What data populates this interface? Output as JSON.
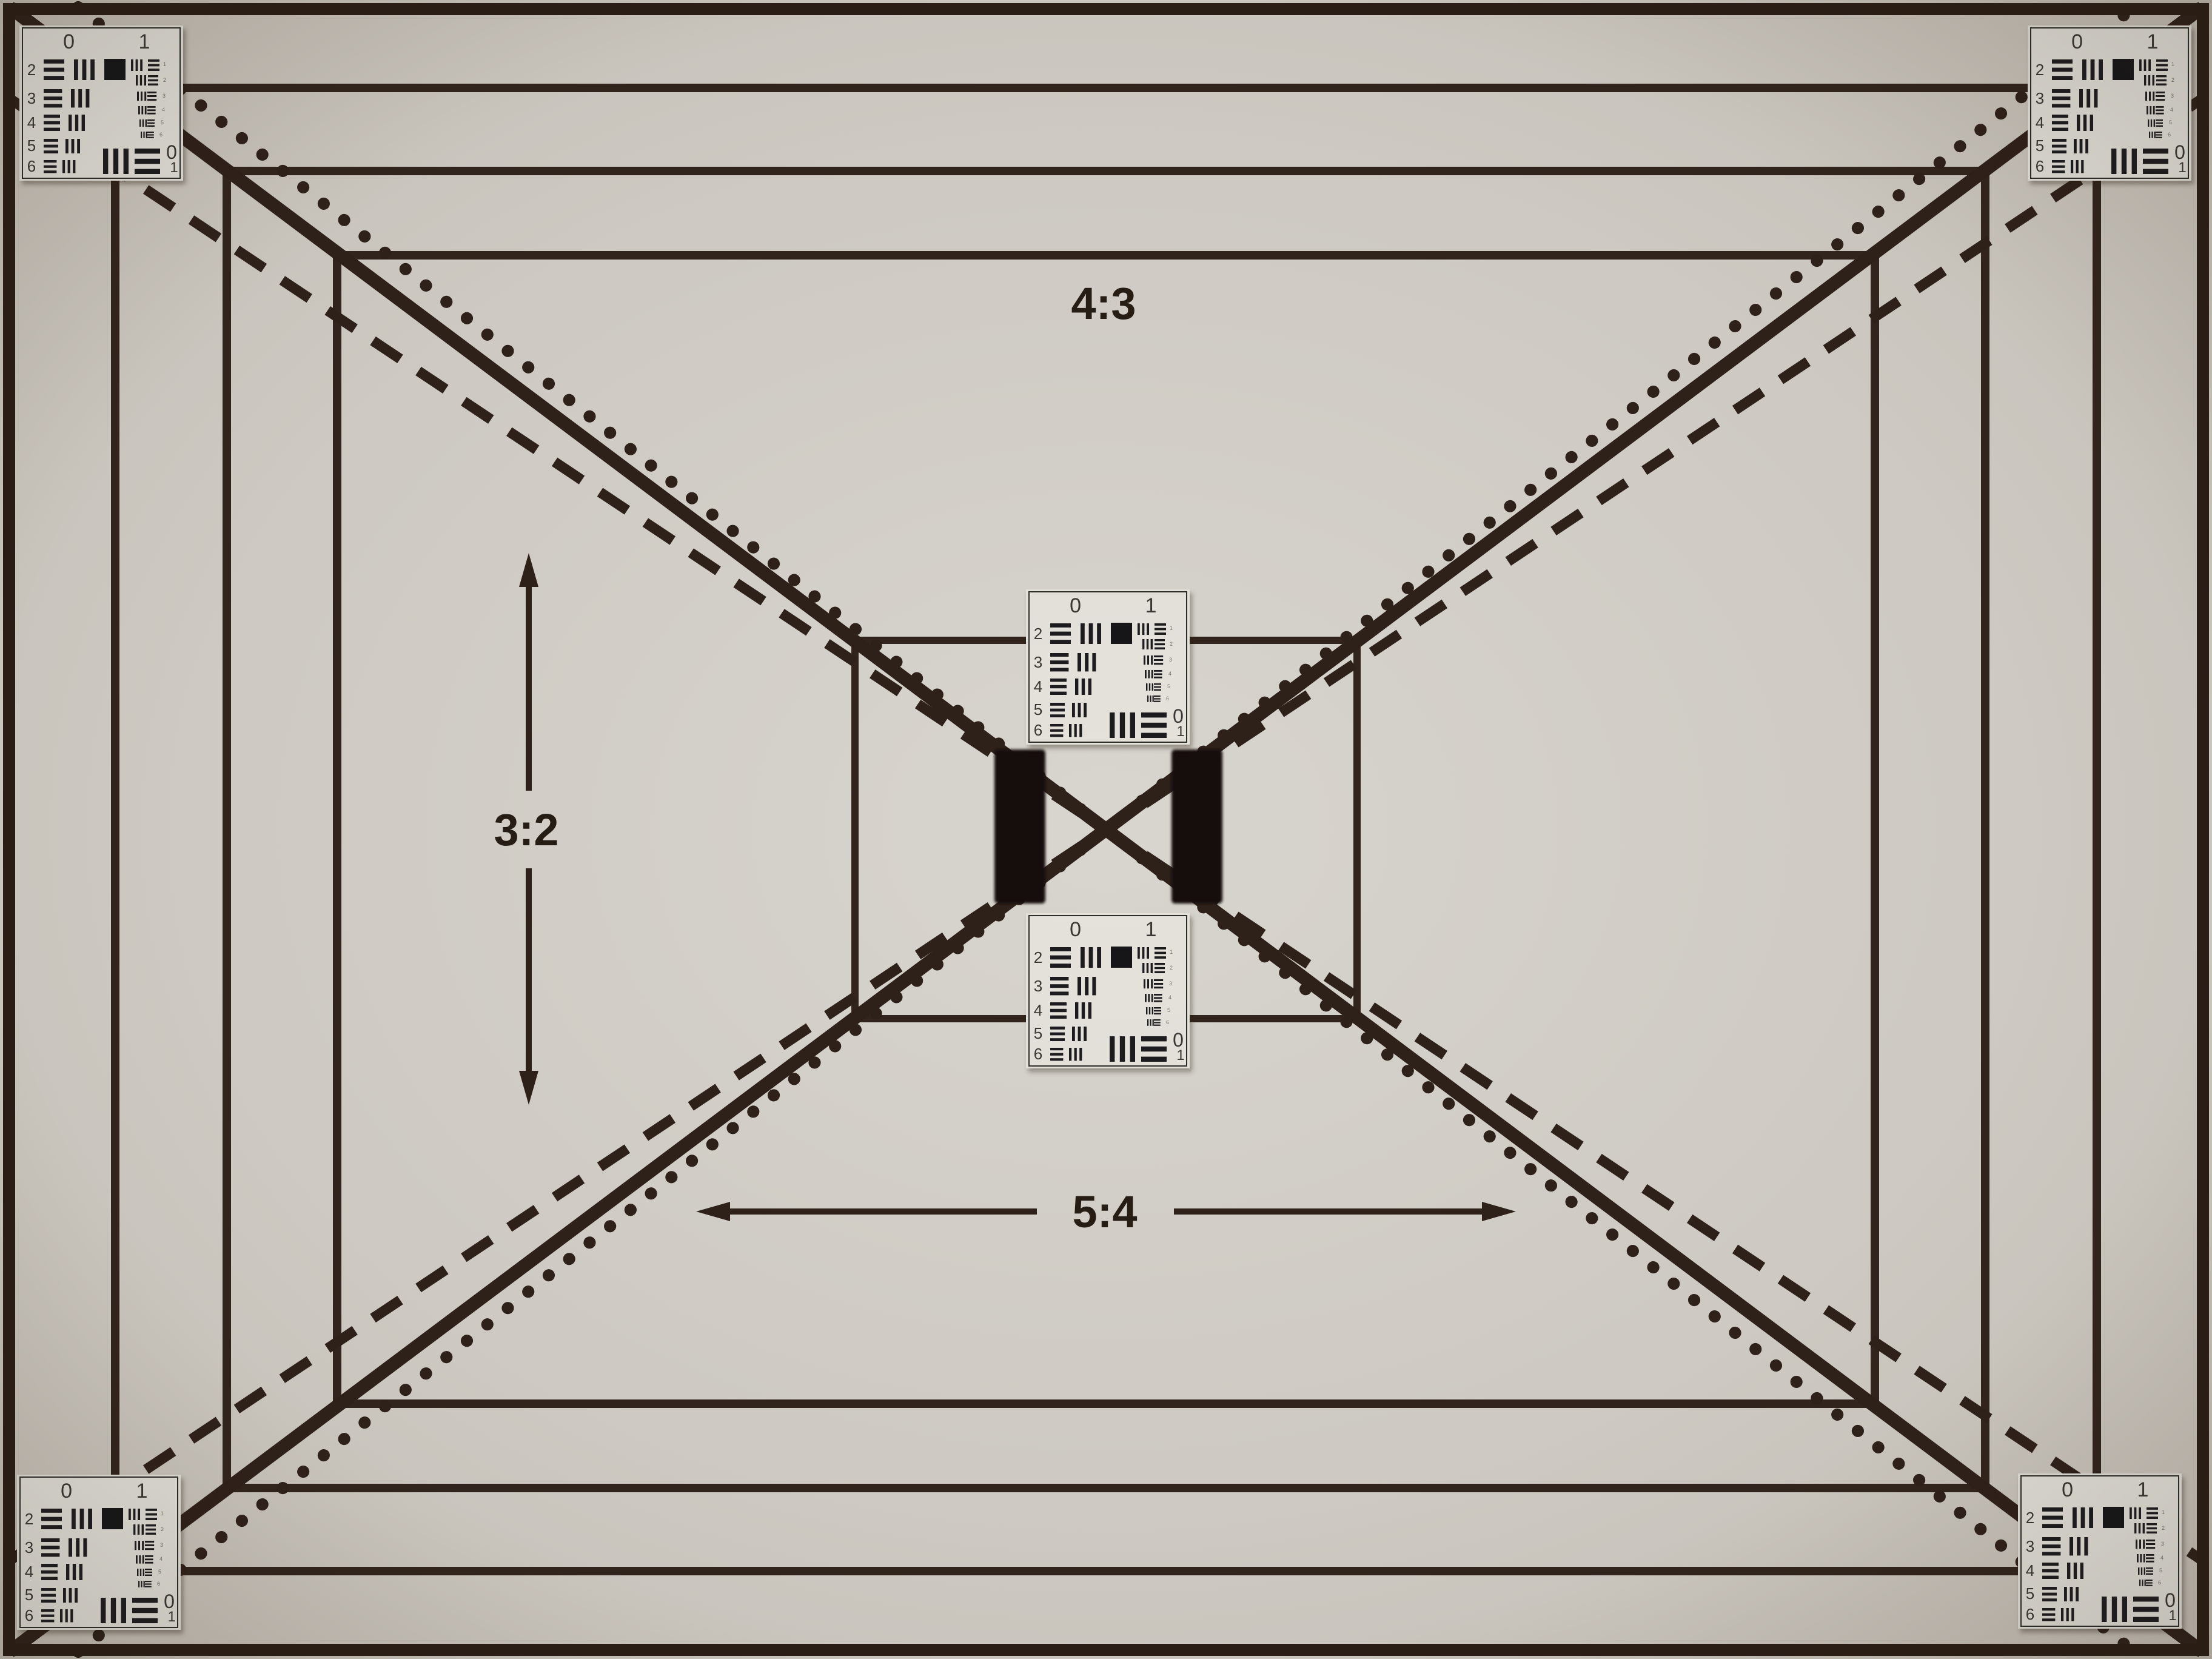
{
  "labels": {
    "top_aspect": "4:3",
    "left_aspect": "3:2",
    "bottom_aspect": "5:4"
  },
  "usaf": {
    "group_label_left": "0",
    "group_label_right": "1",
    "left_numbers": [
      "2",
      "3",
      "4",
      "5",
      "6"
    ],
    "right_numbers": [
      "1",
      "2",
      "3",
      "4",
      "5",
      "6"
    ],
    "bottom_zero": "0",
    "bottom_one": "1"
  },
  "colors": {
    "paper_center": "#d8d5ce",
    "paper_edge": "#c5bfb5",
    "ink_line": "#31241c",
    "border_frame": "#2a1d15",
    "sticker_paper": "#e4e2db",
    "sticker_ink": "#1c1c1e",
    "velcro_patch": "#120e0a"
  }
}
